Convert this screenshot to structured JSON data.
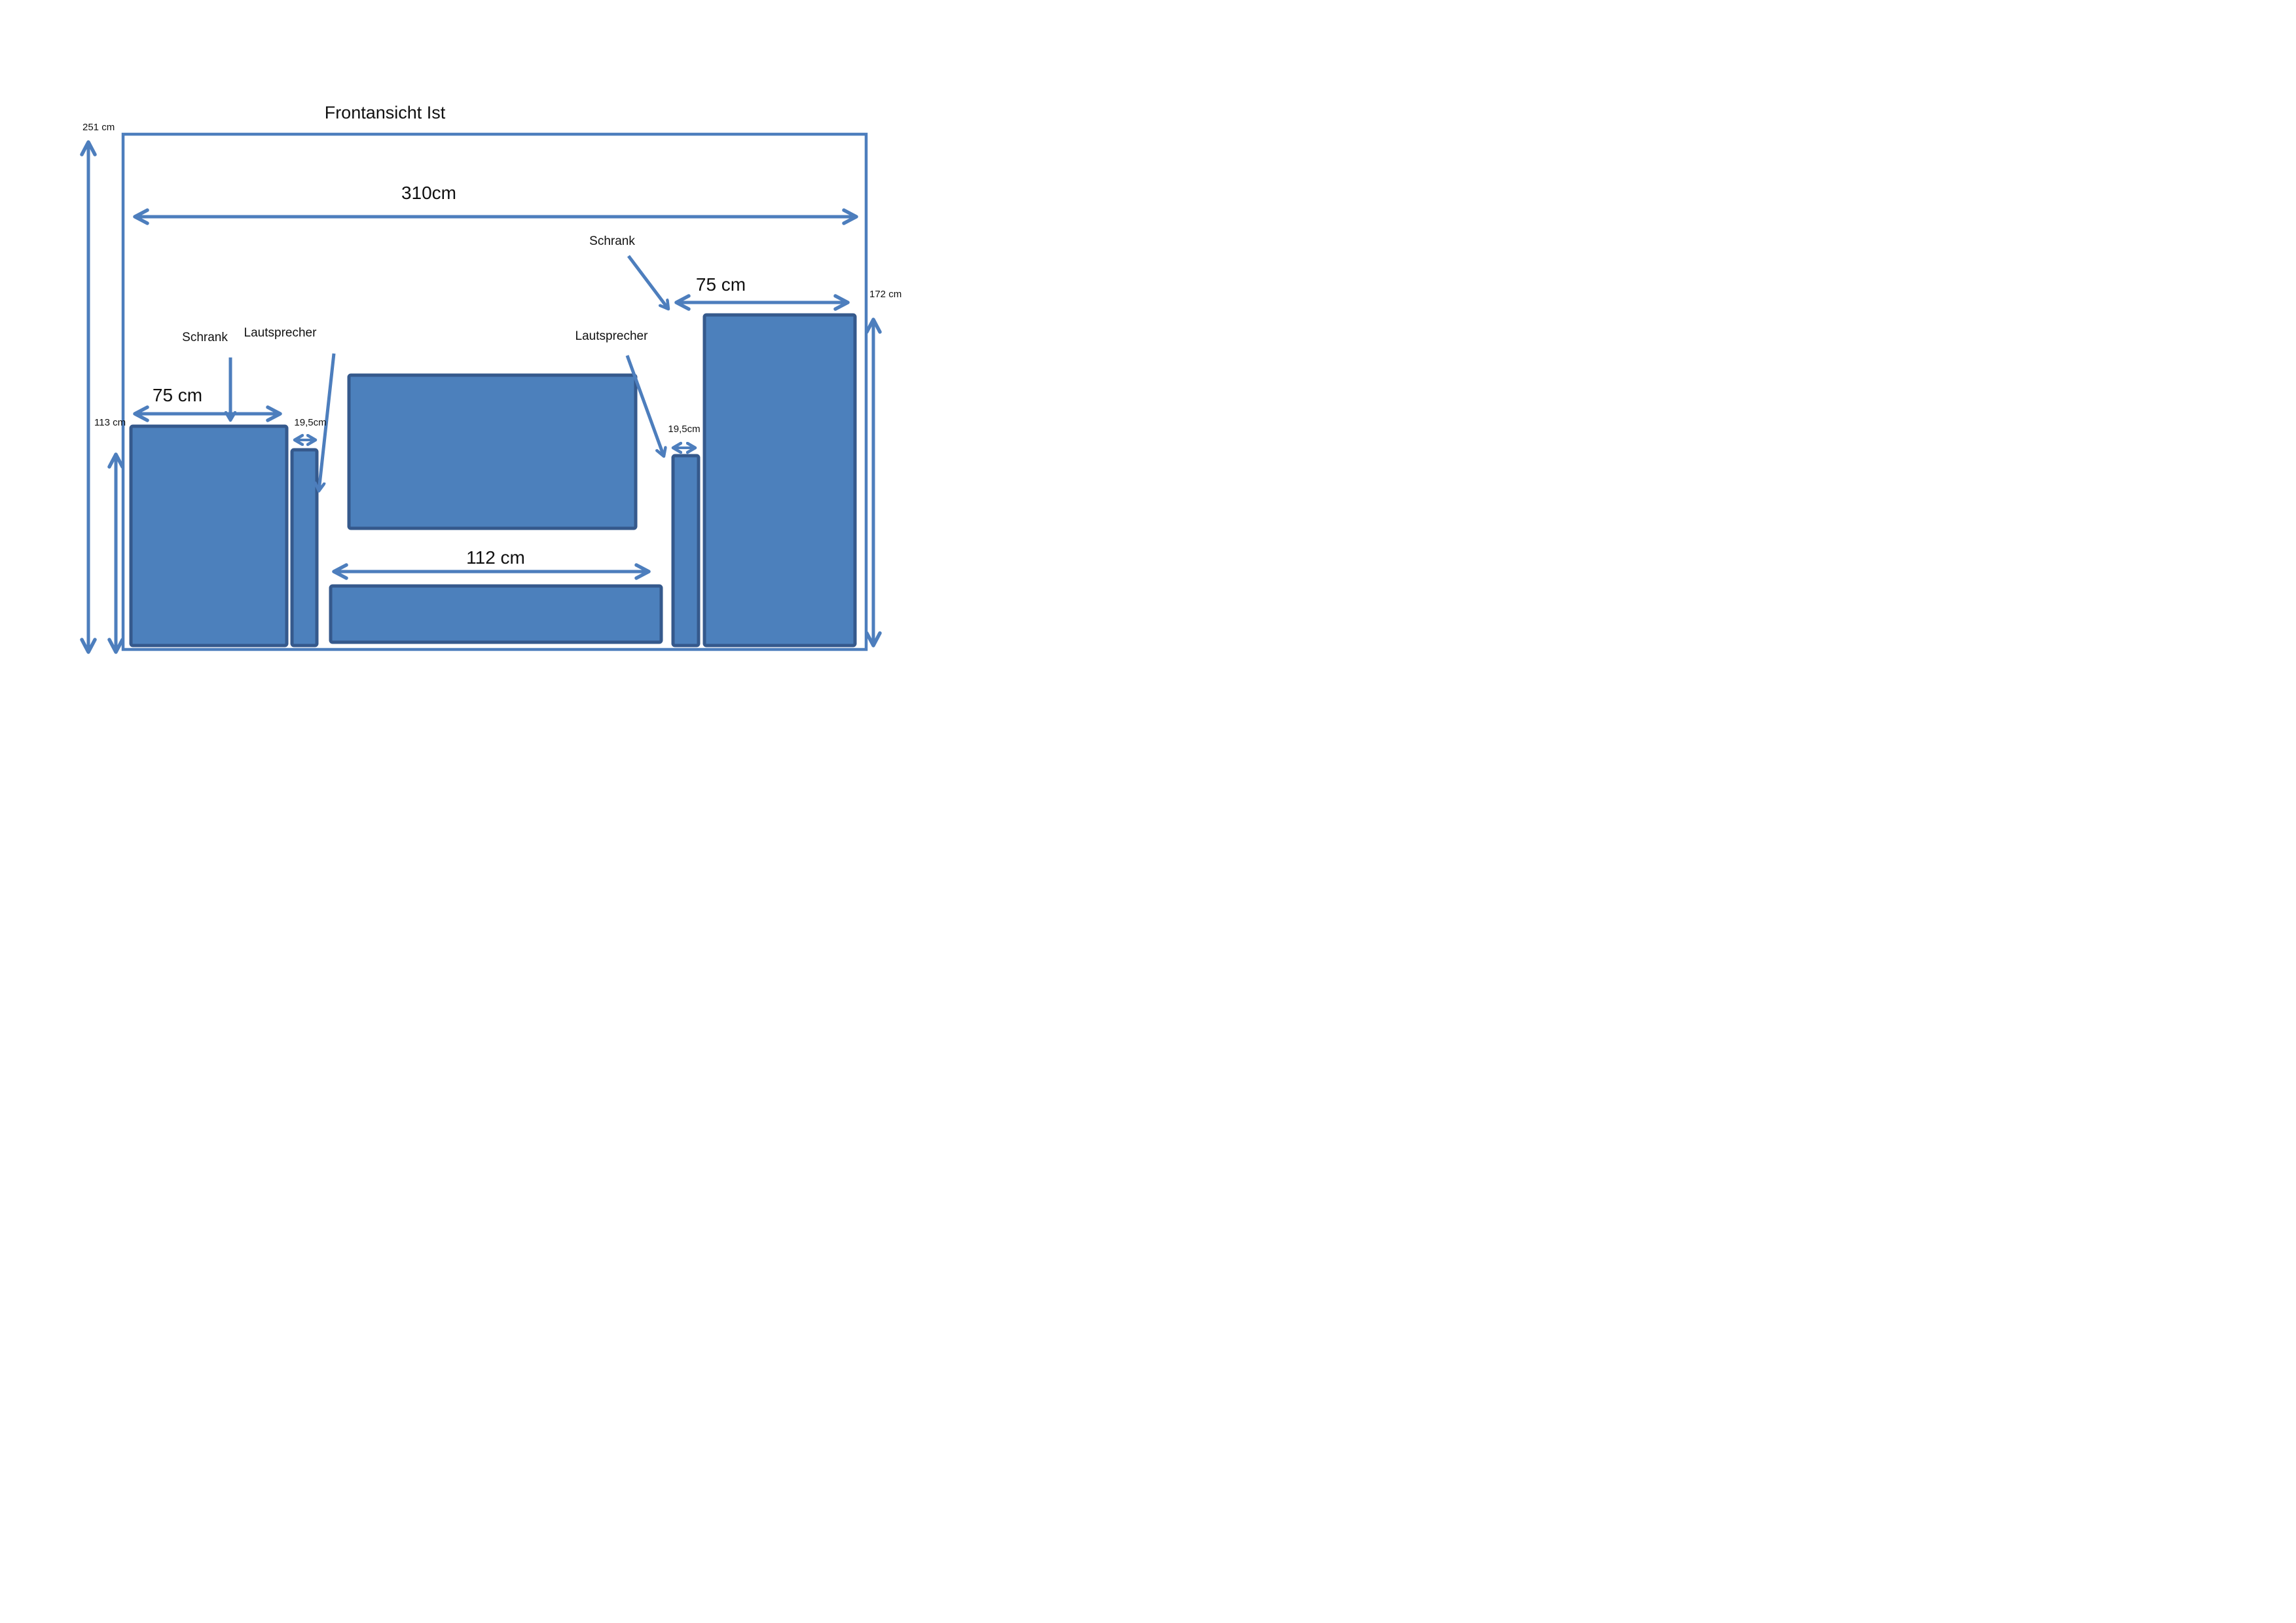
{
  "title": "Frontansicht Ist",
  "colors": {
    "shape_fill": "#4C80BC",
    "shape_border": "#35598C",
    "line_blue": "#4D7EBD",
    "text": "#111111",
    "background": "#FFFFFF"
  },
  "wall": {
    "width_label": "310cm",
    "height_left_label": "251 cm",
    "height_inner_left_label": "113 cm",
    "height_right_label": "172 cm"
  },
  "furniture": {
    "cabinet_left": {
      "label": "Schrank",
      "width_label": "75 cm"
    },
    "speaker_left": {
      "label": "Lautsprecher",
      "width_label": "19,5cm"
    },
    "speaker_right": {
      "label": "Lautsprecher",
      "width_label": "19,5cm"
    },
    "cabinet_right": {
      "label": "Schrank",
      "width_label": "75 cm"
    },
    "lowboard": {
      "width_label": "112 cm"
    }
  }
}
